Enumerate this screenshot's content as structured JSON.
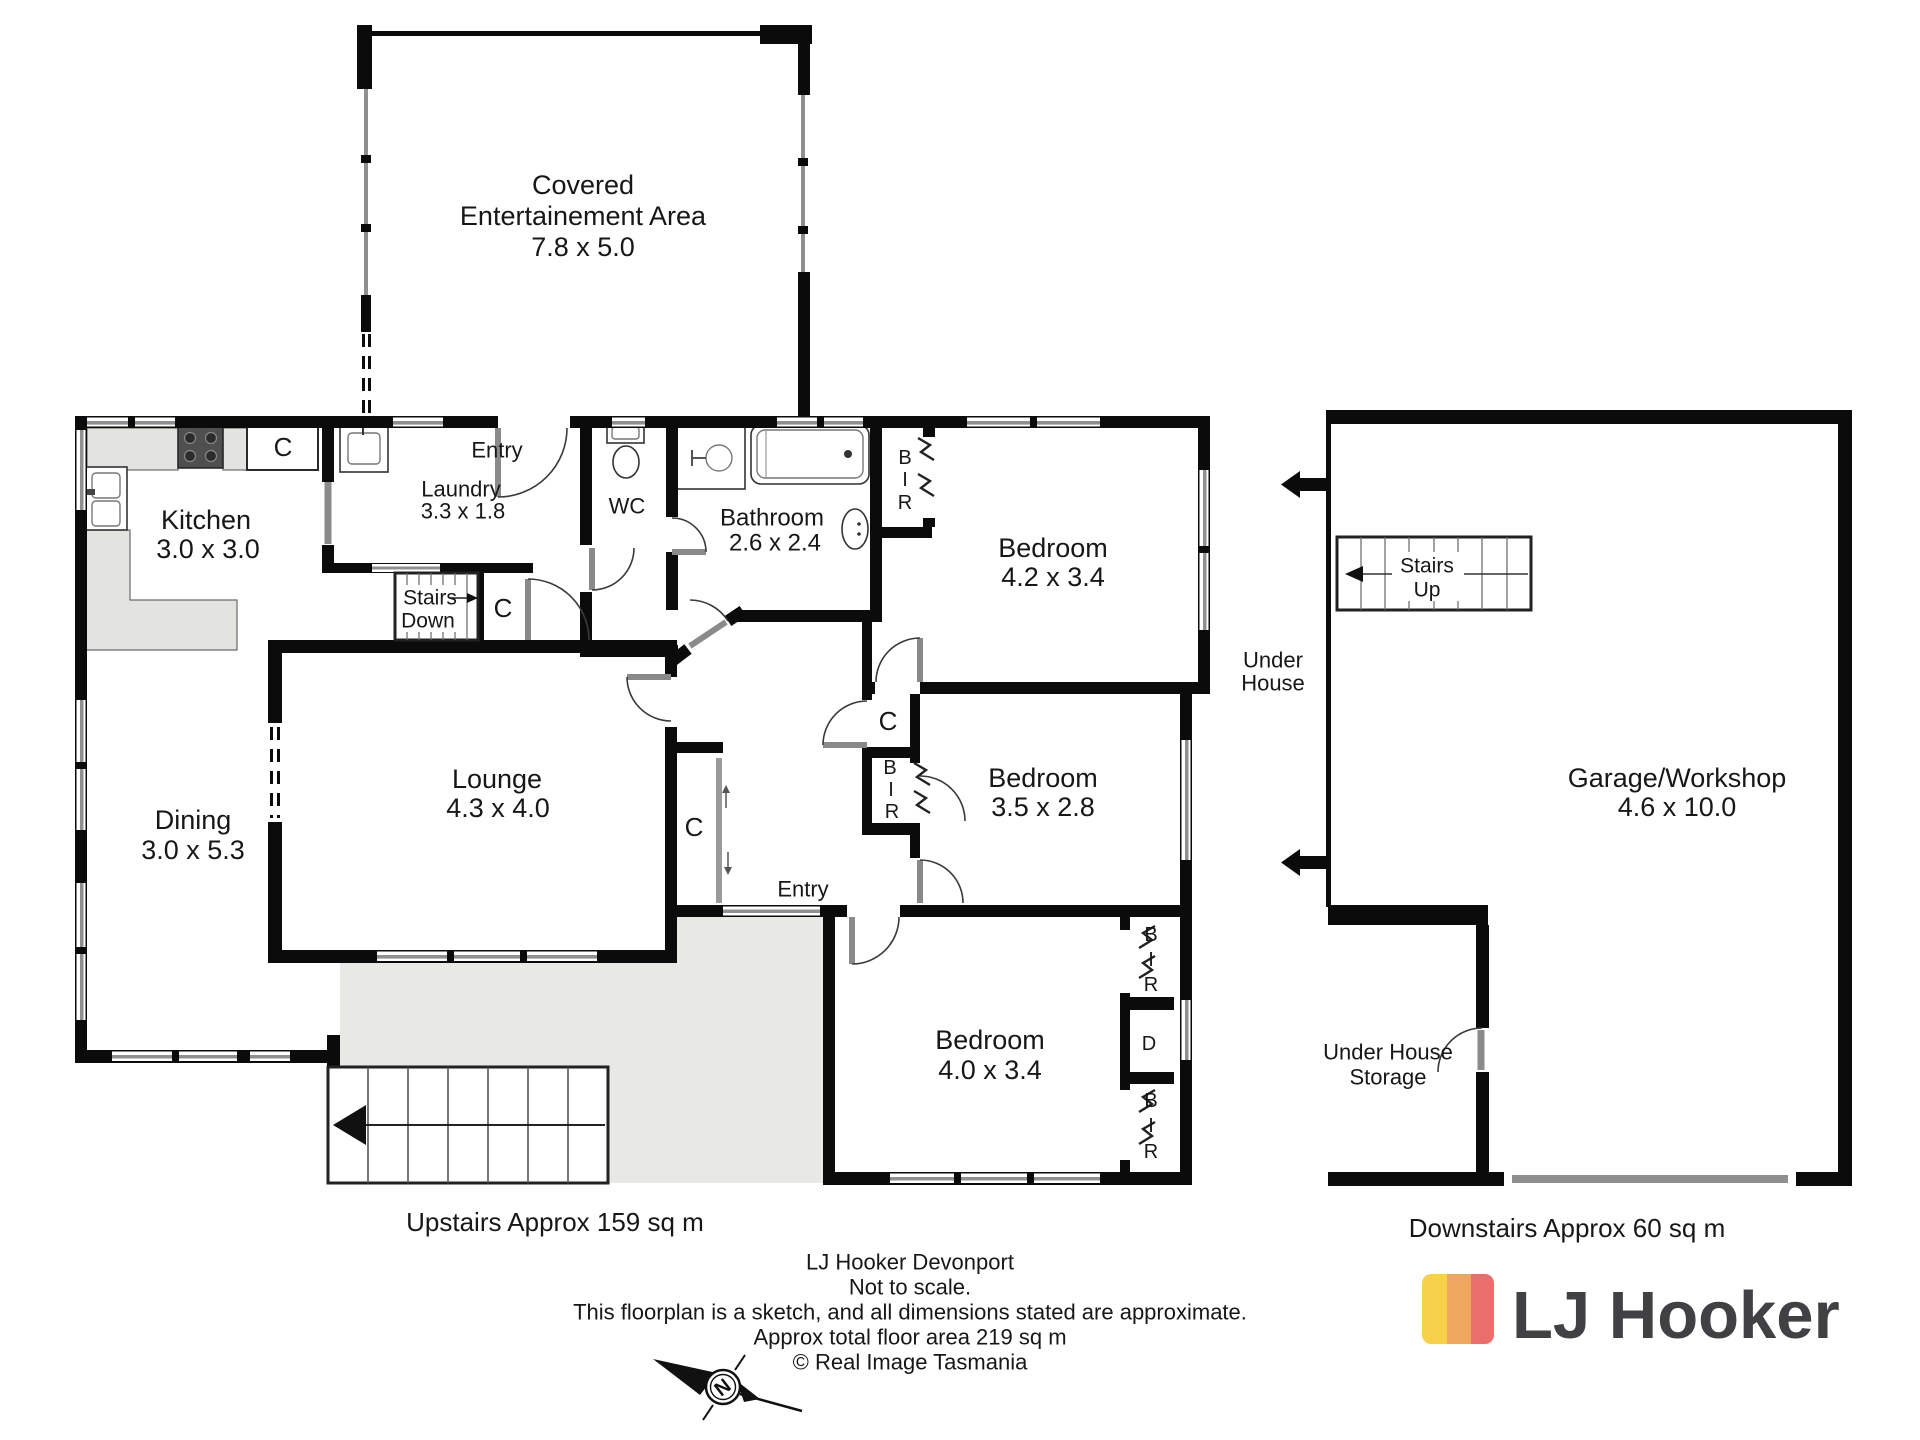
{
  "rooms": {
    "entertainment": {
      "l1": "Covered",
      "l2": "Entertainement Area",
      "dims": "7.8 x 5.0"
    },
    "kitchen": {
      "name": "Kitchen",
      "dims": "3.0 x 3.0"
    },
    "laundry": {
      "name": "Laundry",
      "dims": "3.3 x 1.8"
    },
    "entry_top": {
      "name": "Entry"
    },
    "wc": {
      "name": "WC"
    },
    "bathroom": {
      "name": "Bathroom",
      "dims": "2.6 x 2.4"
    },
    "bedroom1": {
      "name": "Bedroom",
      "dims": "4.2 x 3.4"
    },
    "bedroom2": {
      "name": "Bedroom",
      "dims": "3.5 x 2.8"
    },
    "bedroom3": {
      "name": "Bedroom",
      "dims": "4.0 x 3.4"
    },
    "lounge": {
      "name": "Lounge",
      "dims": "4.3 x 4.0"
    },
    "dining": {
      "name": "Dining",
      "dims": "3.0 x 5.3"
    },
    "entry_mid": {
      "name": "Entry"
    },
    "garage": {
      "name": "Garage/Workshop",
      "dims": "4.6 x 10.0"
    },
    "under_house": {
      "l1": "Under",
      "l2": "House"
    },
    "storage": {
      "l1": "Under House",
      "l2": "Storage"
    }
  },
  "stairs": {
    "down": {
      "l1": "Stairs",
      "l2": "Down"
    },
    "up": {
      "l1": "Stairs",
      "l2": "Up"
    }
  },
  "symbols": {
    "c": "C",
    "b": "B",
    "i": "I",
    "r": "R",
    "d": "D",
    "north": "N"
  },
  "areas": {
    "upstairs": "Upstairs Approx 159 sq m",
    "downstairs": "Downstairs Approx 60 sq m"
  },
  "footer": {
    "l1": "LJ Hooker Devonport",
    "l2": "Not to scale.",
    "l3": "This floorplan is a sketch, and all dimensions stated are approximate.",
    "l4": "Approx total floor area 219 sq m",
    "l5": "© Real Image Tasmania"
  },
  "logo": {
    "text": "LJ Hooker",
    "color_yellow": "#F7D14C",
    "color_orange": "#EFA75F",
    "color_red": "#E96E6C",
    "color_text": "#414042"
  }
}
